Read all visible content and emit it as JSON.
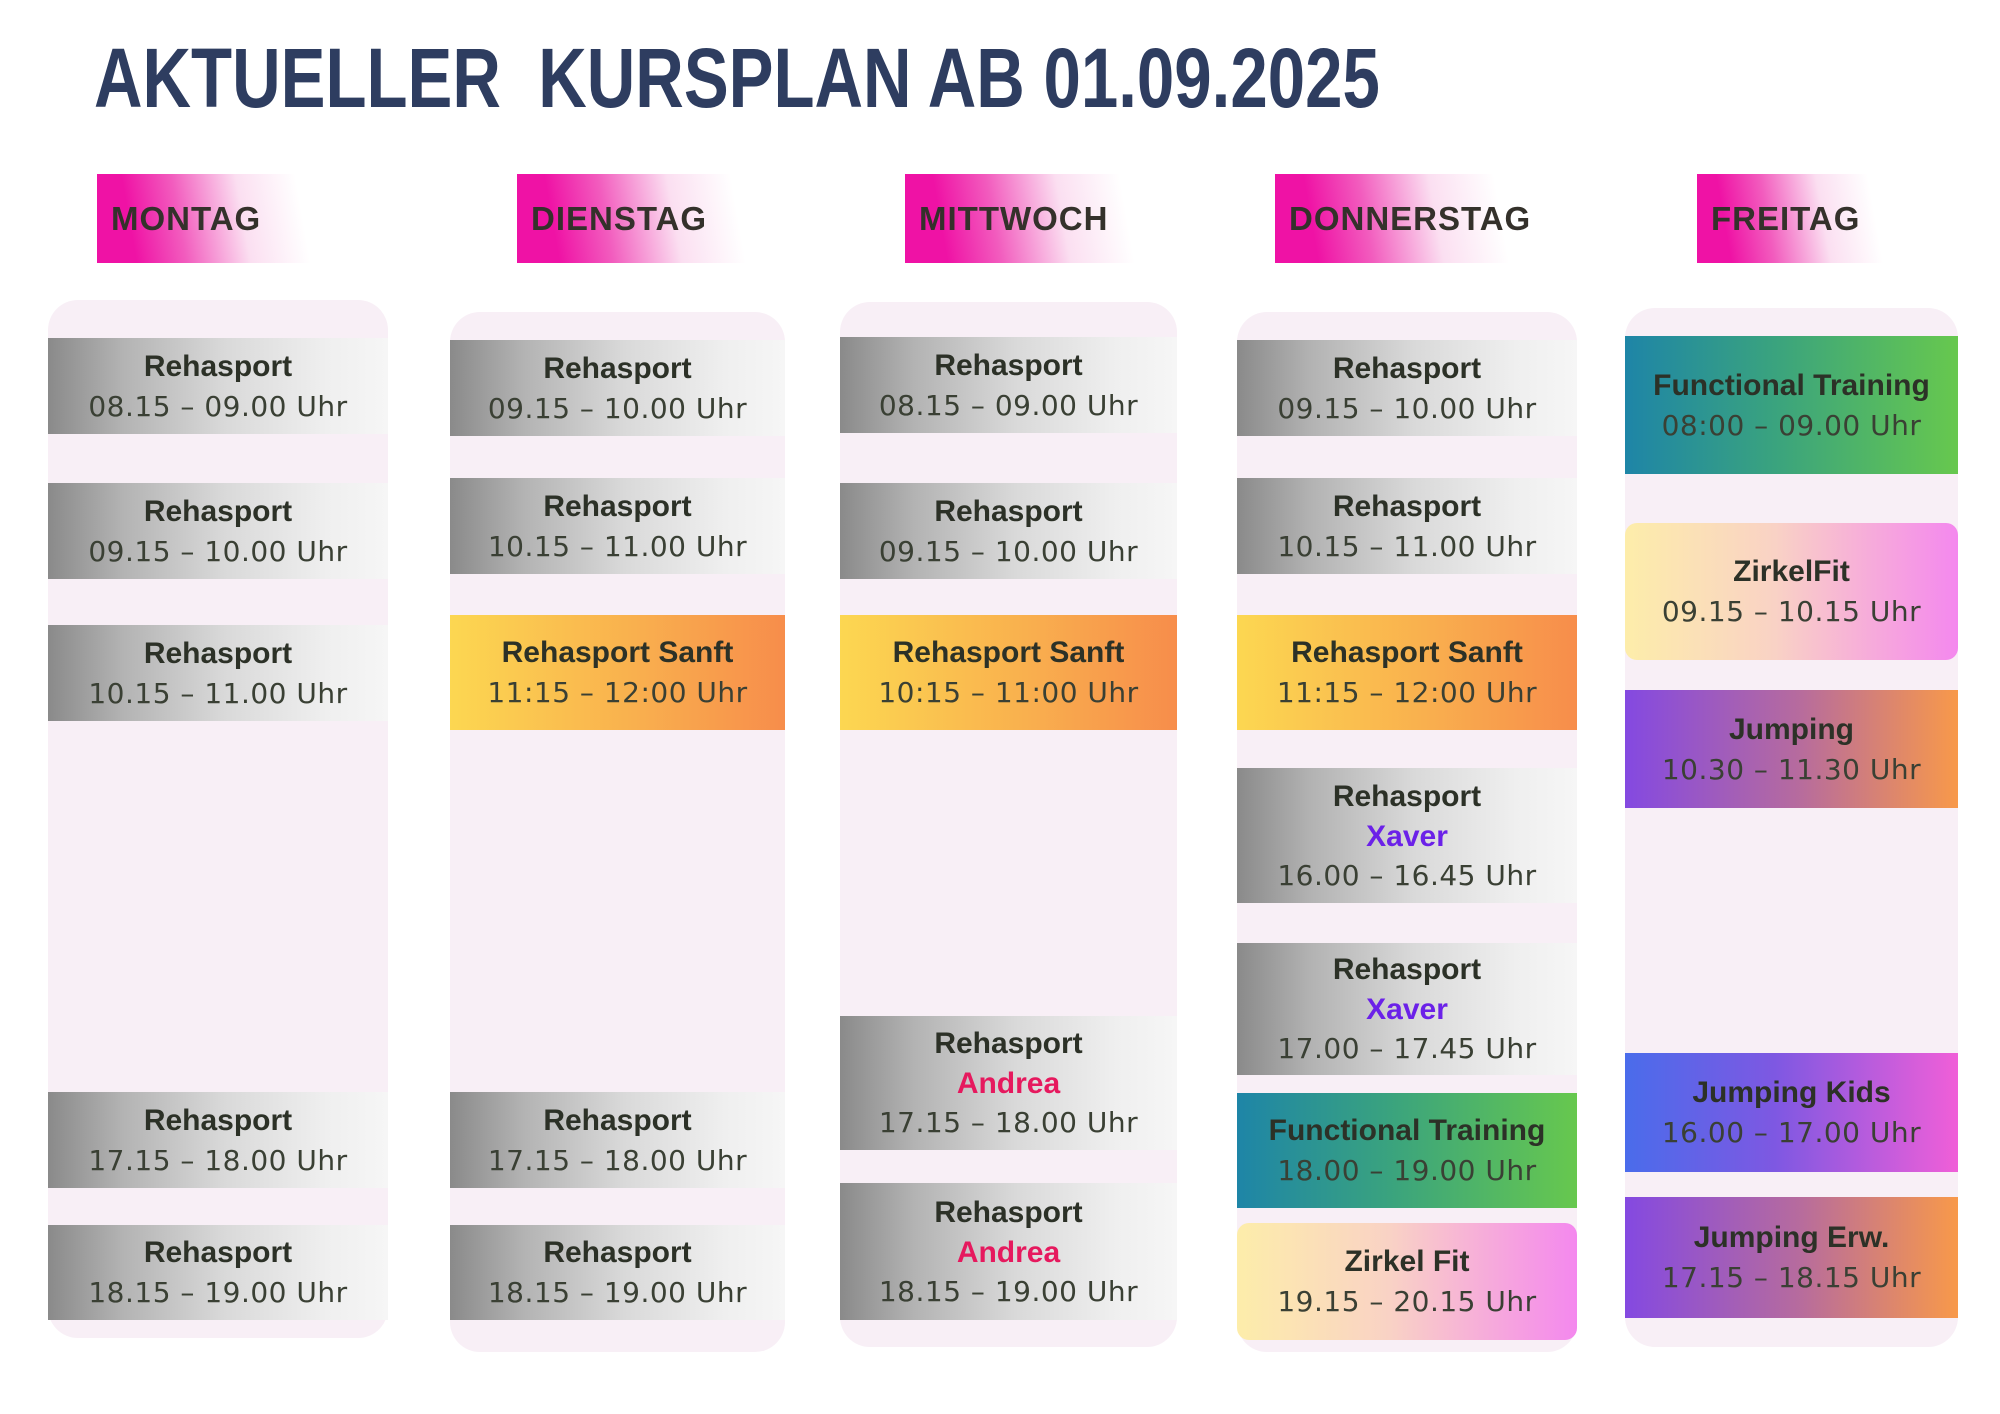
{
  "title": "AKTUELLER  KURSPLAN AB 01.09.2025",
  "colors": {
    "title_navy": "#2e3d60",
    "chip_magenta": "#f013a6",
    "column_bg": "#f8eff6",
    "card_text_dark": "#2c3127",
    "andrea_pink": "#e6195e",
    "xaver_violet": "#6b21e8",
    "sanft_orange": [
      "#fcd751",
      "#f78d4b"
    ],
    "functional_green": [
      "#1e85a7",
      "#67c84e"
    ],
    "zirkel_yellowpink": [
      "#fdedaa",
      "#f488ee"
    ],
    "jumping_purpleorange": [
      "#8449e1",
      "#f8994a"
    ],
    "jumping_kids_bluemagenta": [
      "#4a6ceb",
      "#f05fd8"
    ],
    "silver_card": [
      "#8a8a8a",
      "#f6f6f6"
    ]
  },
  "days": [
    {
      "name": "MONTAG",
      "layout": {
        "chip_x": 97,
        "chip_w": 233,
        "col_x": 48,
        "col_w": 340,
        "col_top": 300,
        "col_h": 1038
      },
      "events": [
        {
          "title": "Rehasport",
          "time": "08.15 – 09.00 Uhr",
          "style": "silver",
          "y": 338,
          "h": 96
        },
        {
          "title": "Rehasport",
          "time": "09.15 – 10.00 Uhr",
          "style": "silver",
          "y": 483,
          "h": 96
        },
        {
          "title": "Rehasport",
          "time": "10.15 – 11.00 Uhr",
          "style": "silver",
          "y": 625,
          "h": 96
        },
        {
          "title": "Rehasport",
          "time": "17.15 – 18.00 Uhr",
          "style": "silver",
          "y": 1092,
          "h": 96
        },
        {
          "title": "Rehasport",
          "time": "18.15 – 19.00 Uhr",
          "style": "silver",
          "y": 1225,
          "h": 95
        }
      ]
    },
    {
      "name": "DIENSTAG",
      "layout": {
        "chip_x": 517,
        "chip_w": 251,
        "col_x": 450,
        "col_w": 335,
        "col_top": 312,
        "col_h": 1040
      },
      "events": [
        {
          "title": "Rehasport",
          "time": "09.15 – 10.00 Uhr",
          "style": "silver",
          "y": 340,
          "h": 96
        },
        {
          "title": "Rehasport",
          "time": "10.15 – 11.00 Uhr",
          "style": "silver",
          "y": 478,
          "h": 96
        },
        {
          "title": "Rehasport Sanft",
          "time": "11:15 – 12:00 Uhr",
          "style": "orange",
          "y": 615,
          "h": 115
        },
        {
          "title": "Rehasport",
          "time": "17.15 – 18.00 Uhr",
          "style": "silver",
          "y": 1092,
          "h": 96
        },
        {
          "title": "Rehasport",
          "time": "18.15 – 19.00 Uhr",
          "style": "silver",
          "y": 1225,
          "h": 95
        }
      ]
    },
    {
      "name": "MITTWOCH",
      "layout": {
        "chip_x": 905,
        "chip_w": 252,
        "col_x": 840,
        "col_w": 337,
        "col_top": 302,
        "col_h": 1045
      },
      "events": [
        {
          "title": "Rehasport",
          "time": "08.15 – 09.00 Uhr",
          "style": "silver",
          "y": 337,
          "h": 96
        },
        {
          "title": "Rehasport",
          "time": "09.15 – 10.00 Uhr",
          "style": "silver",
          "y": 483,
          "h": 96
        },
        {
          "title": "Rehasport Sanft",
          "time": "10:15 – 11:00 Uhr",
          "style": "orange",
          "y": 615,
          "h": 115
        },
        {
          "title": "Rehasport",
          "instructor": "Andrea",
          "instructor_color": "#e6195e",
          "time": "17.15 – 18.00 Uhr",
          "style": "silver",
          "y": 1016,
          "h": 134
        },
        {
          "title": "Rehasport",
          "instructor": "Andrea",
          "instructor_color": "#e6195e",
          "time": "18.15 – 19.00 Uhr",
          "style": "silver",
          "y": 1183,
          "h": 137
        }
      ]
    },
    {
      "name": "DONNERSTAG",
      "layout": {
        "chip_x": 1275,
        "chip_w": 257,
        "col_x": 1237,
        "col_w": 340,
        "col_top": 312,
        "col_h": 1040
      },
      "events": [
        {
          "title": "Rehasport",
          "time": "09.15 – 10.00 Uhr",
          "style": "silver",
          "y": 340,
          "h": 96
        },
        {
          "title": "Rehasport",
          "time": "10.15 – 11.00 Uhr",
          "style": "silver",
          "y": 478,
          "h": 96
        },
        {
          "title": "Rehasport Sanft",
          "time": "11:15 – 12:00 Uhr",
          "style": "orange",
          "y": 615,
          "h": 115
        },
        {
          "title": "Rehasport",
          "instructor": "Xaver",
          "instructor_color": "#6b21e8",
          "time": "16.00 – 16.45 Uhr",
          "style": "silver",
          "y": 768,
          "h": 135
        },
        {
          "title": "Rehasport",
          "instructor": "Xaver",
          "instructor_color": "#6b21e8",
          "time": "17.00 – 17.45 Uhr",
          "style": "silver",
          "y": 943,
          "h": 132
        },
        {
          "title": "Functional Training",
          "time": "18.00 – 19.00 Uhr",
          "style": "tealgreen",
          "y": 1093,
          "h": 115
        },
        {
          "title": "Zirkel Fit",
          "time": "19.15 – 20.15 Uhr",
          "style": "yellowpink",
          "y": 1223,
          "h": 117
        }
      ]
    },
    {
      "name": "FREITAG",
      "layout": {
        "chip_x": 1697,
        "chip_w": 201,
        "col_x": 1625,
        "col_w": 333,
        "col_top": 308,
        "col_h": 1039
      },
      "events": [
        {
          "title": "Functional Training",
          "time": "08:00 – 09.00 Uhr",
          "style": "tealgreen",
          "y": 336,
          "h": 138
        },
        {
          "title": "ZirkelFit",
          "time": "09.15 – 10.15 Uhr",
          "style": "yellowpink",
          "y": 523,
          "h": 137
        },
        {
          "title": "Jumping",
          "time": "10.30 – 11.30 Uhr",
          "style": "purpleorange",
          "y": 690,
          "h": 118
        },
        {
          "title": "Jumping Kids",
          "time": "16.00 – 17.00 Uhr",
          "style": "bluemagenta",
          "y": 1053,
          "h": 119
        },
        {
          "title": "Jumping Erw.",
          "time": "17.15 – 18.15 Uhr",
          "style": "purpleorange",
          "y": 1197,
          "h": 121
        }
      ]
    }
  ]
}
